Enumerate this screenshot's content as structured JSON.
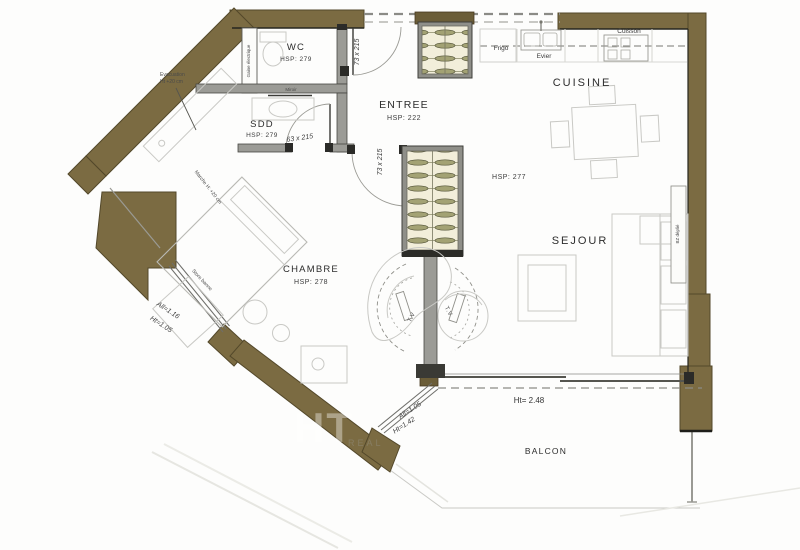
{
  "plan": {
    "watermark": {
      "big": "HT",
      "small": "REAL"
    },
    "rooms": {
      "wc": {
        "label": "WC",
        "hsp": "HSP: 279"
      },
      "sdd": {
        "label": "SDD",
        "hsp": "HSP: 279"
      },
      "entree": {
        "label": "ENTREE",
        "hsp": "HSP: 222"
      },
      "cuisine": {
        "label": "CUISINE",
        "hsp": "HSP: 277"
      },
      "sejour": {
        "label": "SEJOUR"
      },
      "chambre": {
        "label": "CHAMBRE",
        "hsp": "HSP: 278"
      },
      "balcon": {
        "label": "BALCON"
      }
    },
    "kitchen": {
      "frigo": "Frigo",
      "evier": "Evier",
      "cuisson": "Cuisson"
    },
    "doors": {
      "entrance_dim": "73 x 215",
      "sdd_dim": "63 x 215",
      "chambre_dim": "73 x 215"
    },
    "openings": {
      "window_nw": {
        "line1": "All=1.16",
        "line2": "Ht=1.05",
        "store": "Store banne"
      },
      "window_sw": {
        "line1": "All=1.05",
        "line2": "Ht=1.42"
      },
      "bay": {
        "height": "Ht= 2.48"
      }
    },
    "notes": {
      "evac_line1": "Evacuation",
      "evac_line2": "Ht +20 cm",
      "marche": "Marche H: +20 cm",
      "miroir": "Miroir",
      "gaine": "Gaine électrique",
      "bz": "BZ déplié",
      "tv_left": "T.V",
      "tv_right": "T.V"
    },
    "colors": {
      "exterior_wall": "#7b6b42",
      "interior_wall": "#9b9b96",
      "sketch_line": "#c9c9c5"
    }
  }
}
